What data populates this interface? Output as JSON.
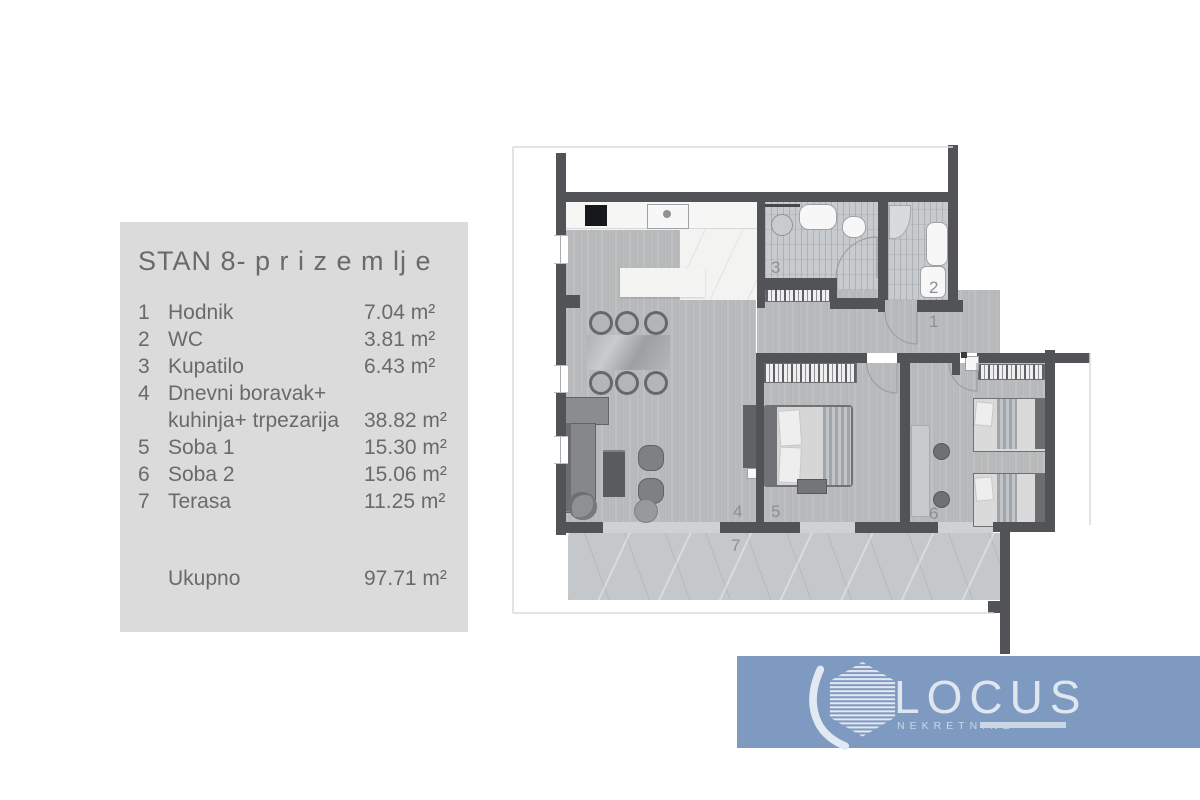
{
  "panel": {
    "title": "STAN 8- p r i z e m lj e",
    "rows": [
      {
        "num": "1",
        "name": "Hodnik",
        "area": "7.04 m²"
      },
      {
        "num": "2",
        "name": "WC",
        "area": "3.81 m²"
      },
      {
        "num": "3",
        "name": "Kupatilo",
        "area": "6.43 m²"
      },
      {
        "num": "4",
        "name": "Dnevni boravak+ kuhinja+ trpezarija",
        "area": "38.82 m²"
      },
      {
        "num": "5",
        "name": "Soba 1",
        "area": "15.30 m²"
      },
      {
        "num": "6",
        "name": "Soba 2",
        "area": "15.06 m²"
      },
      {
        "num": "7",
        "name": "Terasa",
        "area": "11.25 m²"
      }
    ],
    "total_label": "Ukupno",
    "total_area": "97.71 m²"
  },
  "floorplan": {
    "room_numbers": [
      "1",
      "2",
      "3",
      "4",
      "5",
      "6",
      "7"
    ]
  },
  "logo": {
    "brand": "LOCUS",
    "subtitle": "NEKRETNINE",
    "bg_color": "#7e9ac1",
    "text_color": "#dfe6f0"
  },
  "colors": {
    "wall": "#515357",
    "panel_bg": "#dbdbdb",
    "panel_text": "#6a6a6a"
  }
}
